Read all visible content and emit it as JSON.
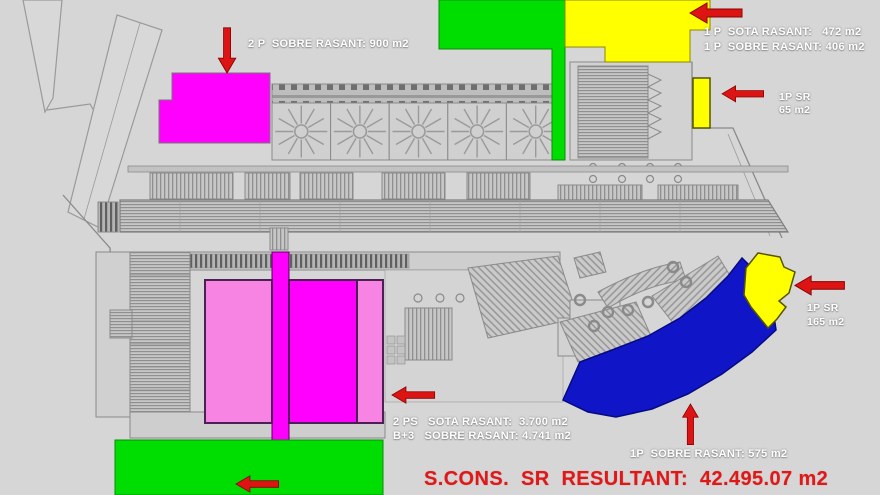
{
  "colors": {
    "background": "#d6d6d6",
    "plan_gray": "#d0d0d0",
    "green": "#00dd00",
    "yellow": "#ffff00",
    "magenta": "#ff00ff",
    "pink": "#f783e3",
    "blue": "#1016c8",
    "arrow_red": "#dd1414",
    "label_white": "#ffffff",
    "total_red": "#e01818"
  },
  "annotations": {
    "top_left": {
      "text": "2 P  SOBRE RASANT: 900 m2"
    },
    "top_right": {
      "line1": "1 P  SOTA RASANT:   472 m2",
      "line2": "1 P  SOBRE RASANT: 406 m2"
    },
    "right_upper": {
      "line1": "1P SR",
      "line2": "65 m2"
    },
    "right_lower": {
      "line1": "1P SR",
      "line2": "165 m2"
    },
    "bottom_center": {
      "line1": "2 PS   SOTA RASANT:  3.700 m2",
      "line2": "B+3   SOBRE RASANT: 4.741 m2"
    },
    "bottom_right": {
      "text": "1P  SOBRE RASANT: 575 m2"
    },
    "total": {
      "text": "S.CONS.  SR  RESULTANT:  42.495.07 m2"
    }
  }
}
